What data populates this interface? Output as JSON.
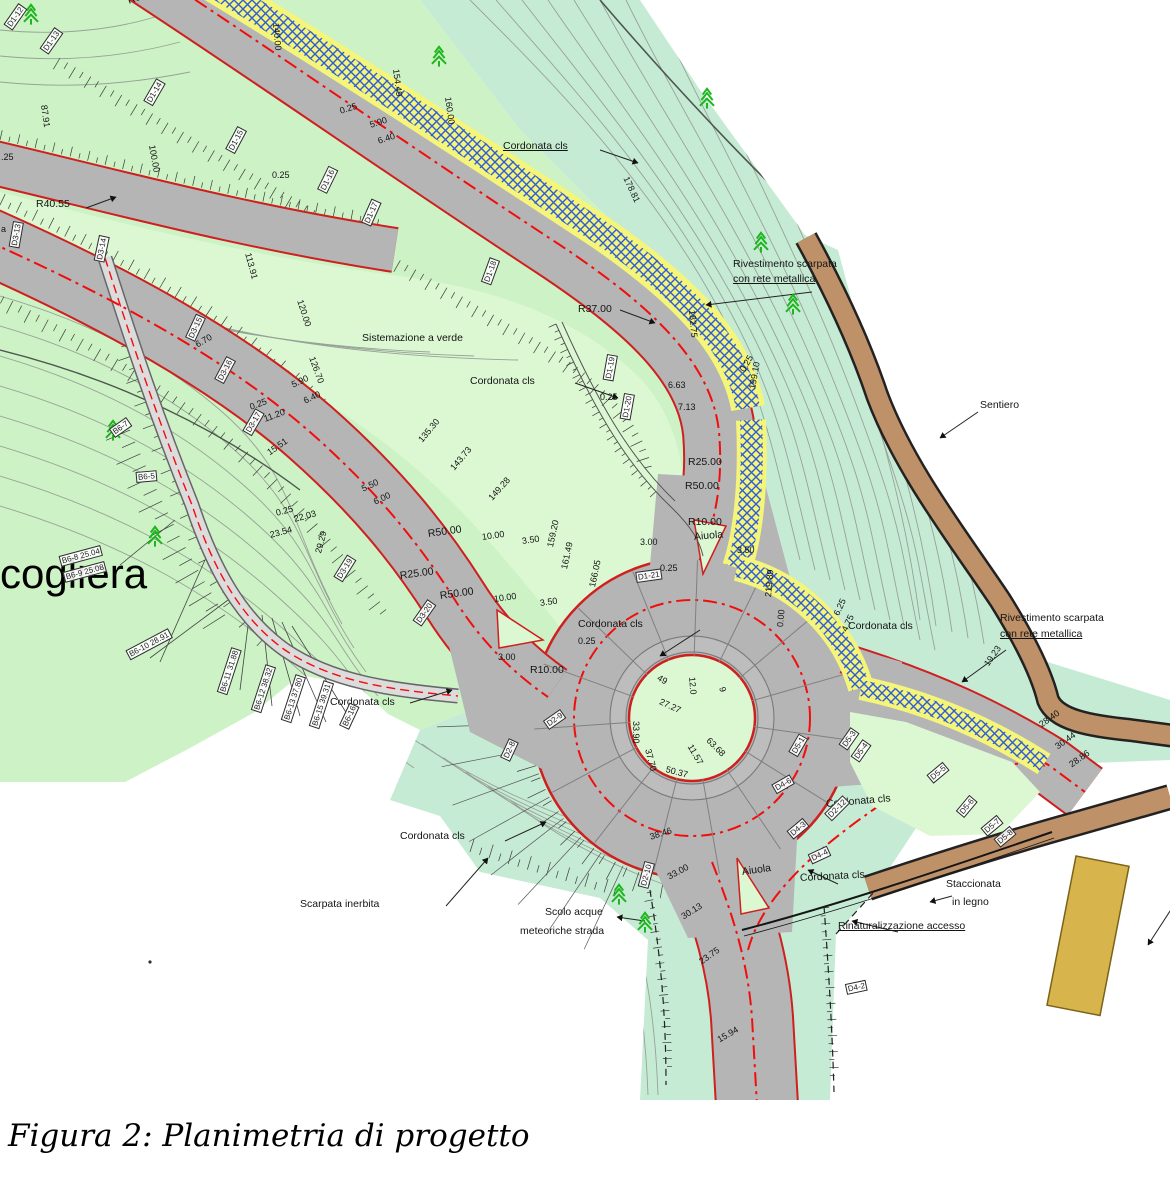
{
  "figure": {
    "caption": "Figura 2: Planimetria di progetto"
  },
  "map": {
    "colors": {
      "green": "#cdf2c5",
      "seafoam": "#c6ebd4",
      "mint": "#dcf8d2",
      "road": "#b5b5b5",
      "track": "#dcdcdc",
      "red_edge": "#cf1f1f",
      "red_dash": "#f20d0d",
      "hatch_yellow": "#f5f57a",
      "hatch_blue": "#2e5bd8",
      "brown": "#bf9169",
      "tan": "#d8b44c",
      "contour": "#97a297",
      "contour_bold": "#4e564e",
      "hatch_tick": "#3c3c3c",
      "tree": "#1db51d",
      "ink": "#111111"
    },
    "trees": [
      [
        22,
        2
      ],
      [
        430,
        44
      ],
      [
        698,
        86
      ],
      [
        752,
        230
      ],
      [
        784,
        292
      ],
      [
        104,
        418
      ],
      [
        146,
        524
      ],
      [
        610,
        882
      ],
      [
        636,
        910
      ]
    ],
    "point_marker": [
      150,
      962
    ],
    "labels": [
      {
        "t": "Cordonata cls",
        "x": 503,
        "y": 140,
        "r": 0,
        "c": "u"
      },
      {
        "t": "Rivestimento scarpata",
        "x": 733,
        "y": 258,
        "r": 0
      },
      {
        "t": "con rete metallica",
        "x": 733,
        "y": 273,
        "r": 0,
        "c": "u"
      },
      {
        "t": "Sentiero",
        "x": 980,
        "y": 399,
        "r": 0
      },
      {
        "t": "Sistemazione a verde",
        "x": 362,
        "y": 332,
        "r": 0
      },
      {
        "t": "Cordonata cls",
        "x": 470,
        "y": 375,
        "r": 0
      },
      {
        "t": "R37.00",
        "x": 578,
        "y": 303,
        "r": 0
      },
      {
        "t": "0.25",
        "x": 600,
        "y": 392,
        "r": 0,
        "c": "s"
      },
      {
        "t": "6.63",
        "x": 668,
        "y": 380,
        "r": 0,
        "c": "s"
      },
      {
        "t": "7.13",
        "x": 678,
        "y": 402,
        "r": 0,
        "c": "s"
      },
      {
        "t": "0.25",
        "x": 742,
        "y": 366,
        "r": -60,
        "c": "s"
      },
      {
        "t": "199.10",
        "x": 752,
        "y": 384,
        "r": -80,
        "c": "s"
      },
      {
        "t": "R25.00",
        "x": 688,
        "y": 456,
        "r": 0
      },
      {
        "t": "R50.00",
        "x": 685,
        "y": 480,
        "r": 0
      },
      {
        "t": "R10.00",
        "x": 688,
        "y": 516,
        "r": 0
      },
      {
        "t": "Aiuola",
        "x": 694,
        "y": 531,
        "r": -5
      },
      {
        "t": "3.50",
        "x": 737,
        "y": 545,
        "r": 0,
        "c": "s"
      },
      {
        "t": "0.25",
        "x": 660,
        "y": 563,
        "r": 0,
        "c": "s"
      },
      {
        "t": "3.00",
        "x": 640,
        "y": 537,
        "r": 0,
        "c": "s"
      },
      {
        "t": "R85.00",
        "x": 128,
        "y": -5,
        "r": -20
      },
      {
        "t": "0.25",
        "x": 340,
        "y": 106,
        "r": -18,
        "c": "s"
      },
      {
        "t": "5.90",
        "x": 370,
        "y": 120,
        "r": -18,
        "c": "s"
      },
      {
        "t": "6.40",
        "x": 378,
        "y": 136,
        "r": -18,
        "c": "s"
      },
      {
        "t": "0.25",
        "x": 272,
        "y": 170,
        "r": 0,
        "c": "s"
      },
      {
        "t": ".25",
        "x": 1,
        "y": 152,
        "r": 0,
        "c": "s"
      },
      {
        "t": "R40.55",
        "x": 36,
        "y": 198,
        "r": 0
      },
      {
        "t": "a",
        "x": 1,
        "y": 224,
        "r": 0,
        "c": "s"
      },
      {
        "t": "cogliera",
        "x": 0,
        "y": 552,
        "r": 0,
        "c": "big"
      },
      {
        "t": "Cordonata cls",
        "x": 330,
        "y": 696,
        "r": 0
      },
      {
        "t": "R25.00",
        "x": 400,
        "y": 570,
        "r": -8
      },
      {
        "t": "R50.00",
        "x": 428,
        "y": 528,
        "r": -8
      },
      {
        "t": "10.00",
        "x": 482,
        "y": 532,
        "r": -8,
        "c": "s"
      },
      {
        "t": "3.50",
        "x": 522,
        "y": 536,
        "r": -8,
        "c": "s"
      },
      {
        "t": "R50.00",
        "x": 440,
        "y": 590,
        "r": -8
      },
      {
        "t": "10.00",
        "x": 494,
        "y": 594,
        "r": -8,
        "c": "s"
      },
      {
        "t": "3.50",
        "x": 540,
        "y": 598,
        "r": -8,
        "c": "s"
      },
      {
        "t": "0.25",
        "x": 578,
        "y": 636,
        "r": 0,
        "c": "s"
      },
      {
        "t": "3.00",
        "x": 498,
        "y": 652,
        "r": 0,
        "c": "s"
      },
      {
        "t": "R10.00",
        "x": 530,
        "y": 664,
        "r": 0
      },
      {
        "t": "Cordonata cls",
        "x": 578,
        "y": 618,
        "r": 0
      },
      {
        "t": "5.50",
        "x": 362,
        "y": 484,
        "r": -25,
        "c": "s"
      },
      {
        "t": "6.00",
        "x": 374,
        "y": 497,
        "r": -25,
        "c": "s"
      },
      {
        "t": "5.90",
        "x": 292,
        "y": 380,
        "r": -25,
        "c": "s"
      },
      {
        "t": "6.40",
        "x": 304,
        "y": 396,
        "r": -25,
        "c": "s"
      },
      {
        "t": "6.70",
        "x": 196,
        "y": 340,
        "r": -30,
        "c": "s"
      },
      {
        "t": "0.25",
        "x": 250,
        "y": 402,
        "r": -20,
        "c": "s"
      },
      {
        "t": "11.20",
        "x": 264,
        "y": 414,
        "r": -20,
        "c": "s"
      },
      {
        "t": "15.51",
        "x": 268,
        "y": 448,
        "r": -35,
        "c": "s"
      },
      {
        "t": "0.25",
        "x": 276,
        "y": 508,
        "r": -15,
        "c": "s"
      },
      {
        "t": "22.03",
        "x": 294,
        "y": 514,
        "r": -15,
        "c": "s"
      },
      {
        "t": "23.54",
        "x": 270,
        "y": 530,
        "r": -15,
        "c": "s"
      },
      {
        "t": "29.29",
        "x": 318,
        "y": 548,
        "r": -75,
        "c": "s"
      },
      {
        "t": "Scarpata inerbita",
        "x": 300,
        "y": 898,
        "r": 0
      },
      {
        "t": "Scolo acque",
        "x": 545,
        "y": 906,
        "r": 0
      },
      {
        "t": "meteoriche strada",
        "x": 520,
        "y": 925,
        "r": 0
      },
      {
        "t": "Cordonata cls",
        "x": 400,
        "y": 830,
        "r": 0
      },
      {
        "t": "38.46",
        "x": 650,
        "y": 832,
        "r": -18,
        "c": "s"
      },
      {
        "t": "33.00",
        "x": 668,
        "y": 872,
        "r": -28,
        "c": "s"
      },
      {
        "t": "30.13",
        "x": 682,
        "y": 912,
        "r": -32,
        "c": "s"
      },
      {
        "t": "23.75",
        "x": 700,
        "y": 957,
        "r": -35,
        "c": "s"
      },
      {
        "t": "15.94",
        "x": 718,
        "y": 1035,
        "r": -30,
        "c": "s"
      },
      {
        "t": "Aiuola",
        "x": 742,
        "y": 866,
        "r": -8
      },
      {
        "t": "Cordonata cls",
        "x": 800,
        "y": 872,
        "r": -3
      },
      {
        "t": "Staccionata",
        "x": 946,
        "y": 878,
        "r": 0
      },
      {
        "t": "in legno",
        "x": 952,
        "y": 896,
        "r": 0
      },
      {
        "t": "Rinaturalizzazione accesso",
        "x": 838,
        "y": 920,
        "r": 0,
        "c": "u"
      },
      {
        "t": "Cordonata cls",
        "x": 848,
        "y": 620,
        "r": 0
      },
      {
        "t": "Cordonata cls",
        "x": 826,
        "y": 798,
        "r": -5
      },
      {
        "t": "Rivestimento scarpata",
        "x": 1000,
        "y": 612,
        "r": 0
      },
      {
        "t": "con rete metallica",
        "x": 1000,
        "y": 628,
        "r": 0,
        "c": "u"
      },
      {
        "t": "6.25",
        "x": 836,
        "y": 610,
        "r": -65,
        "c": "s"
      },
      {
        "t": "4.75",
        "x": 844,
        "y": 626,
        "r": -65,
        "c": "s"
      },
      {
        "t": "19.23",
        "x": 986,
        "y": 660,
        "r": -55,
        "c": "s"
      },
      {
        "t": "28.40",
        "x": 1040,
        "y": 720,
        "r": -35,
        "c": "s"
      },
      {
        "t": "30.44",
        "x": 1056,
        "y": 742,
        "r": -35,
        "c": "s"
      },
      {
        "t": "28.86",
        "x": 1070,
        "y": 760,
        "r": -35,
        "c": "s"
      },
      {
        "t": "87.91",
        "x": 44,
        "y": 100,
        "r": 82,
        "c": "s"
      },
      {
        "t": "100.00",
        "x": 152,
        "y": 140,
        "r": 80,
        "c": "s"
      },
      {
        "t": "113.91",
        "x": 248,
        "y": 248,
        "r": 75,
        "c": "s"
      },
      {
        "t": "120.00",
        "x": 300,
        "y": 295,
        "r": 72,
        "c": "s"
      },
      {
        "t": "126.70",
        "x": 312,
        "y": 352,
        "r": 70,
        "c": "s"
      },
      {
        "t": "140.00",
        "x": 276,
        "y": 18,
        "r": 85,
        "c": "s"
      },
      {
        "t": "154.49",
        "x": 396,
        "y": 64,
        "r": 83,
        "c": "s"
      },
      {
        "t": "160.00",
        "x": 448,
        "y": 92,
        "r": 82,
        "c": "s"
      },
      {
        "t": "178.81",
        "x": 626,
        "y": 172,
        "r": 65,
        "c": "s"
      },
      {
        "t": "182.75",
        "x": 692,
        "y": 305,
        "r": 85,
        "c": "s"
      },
      {
        "t": "135.30",
        "x": 420,
        "y": 436,
        "r": -50,
        "c": "s"
      },
      {
        "t": "143.73",
        "x": 452,
        "y": 464,
        "r": -50,
        "c": "s"
      },
      {
        "t": "149.28",
        "x": 490,
        "y": 494,
        "r": -48,
        "c": "s"
      },
      {
        "t": "159.20",
        "x": 550,
        "y": 542,
        "r": -78,
        "c": "s"
      },
      {
        "t": "161.49",
        "x": 564,
        "y": 564,
        "r": -78,
        "c": "s"
      },
      {
        "t": "166.05",
        "x": 592,
        "y": 582,
        "r": -78,
        "c": "s"
      },
      {
        "t": "219.89",
        "x": 768,
        "y": 592,
        "r": -85,
        "c": "s"
      },
      {
        "t": "0.00",
        "x": 780,
        "y": 622,
        "r": -85,
        "c": "s"
      },
      {
        "t": "33.90",
        "x": 636,
        "y": 716,
        "r": 90,
        "c": "s"
      },
      {
        "t": "37.70",
        "x": 648,
        "y": 744,
        "r": 75,
        "c": "s"
      },
      {
        "t": "27.27",
        "x": 660,
        "y": 696,
        "r": 25,
        "c": "s"
      },
      {
        "t": "11.57",
        "x": 690,
        "y": 740,
        "r": 60,
        "c": "s"
      },
      {
        "t": "50.37",
        "x": 666,
        "y": 764,
        "r": 15,
        "c": "s"
      },
      {
        "t": "63.68",
        "x": 708,
        "y": 734,
        "r": 45,
        "c": "s"
      },
      {
        "t": "12.0",
        "x": 692,
        "y": 672,
        "r": 85,
        "c": "s"
      },
      {
        "t": "49",
        "x": 658,
        "y": 672,
        "r": 30,
        "c": "s"
      },
      {
        "t": "9",
        "x": 722,
        "y": 682,
        "r": 75,
        "c": "s"
      },
      {
        "t": "D1-12",
        "x": 8,
        "y": 22,
        "r": -55,
        "c": "b"
      },
      {
        "t": "D1-13",
        "x": 44,
        "y": 46,
        "r": -55,
        "c": "b"
      },
      {
        "t": "D1-14",
        "x": 148,
        "y": 98,
        "r": -60,
        "c": "b"
      },
      {
        "t": "D1-15",
        "x": 230,
        "y": 146,
        "r": -62,
        "c": "b"
      },
      {
        "t": "D1-16",
        "x": 322,
        "y": 186,
        "r": -64,
        "c": "b"
      },
      {
        "t": "D1-17",
        "x": 366,
        "y": 219,
        "r": -66,
        "c": "b"
      },
      {
        "t": "D1-18",
        "x": 486,
        "y": 278,
        "r": -70,
        "c": "b"
      },
      {
        "t": "D1-19",
        "x": 608,
        "y": 375,
        "r": -80,
        "c": "b"
      },
      {
        "t": "D1-20",
        "x": 625,
        "y": 414,
        "r": -80,
        "c": "b"
      },
      {
        "t": "D1-21",
        "x": 636,
        "y": 572,
        "r": -8,
        "c": "b"
      },
      {
        "t": "D3-13",
        "x": 14,
        "y": 242,
        "r": -80,
        "c": "b"
      },
      {
        "t": "D3-14",
        "x": 99,
        "y": 256,
        "r": -78,
        "c": "b"
      },
      {
        "t": "D3-15",
        "x": 190,
        "y": 334,
        "r": -65,
        "c": "b"
      },
      {
        "t": "D3-16",
        "x": 219,
        "y": 376,
        "r": -62,
        "c": "b"
      },
      {
        "t": "D3-17",
        "x": 247,
        "y": 428,
        "r": -60,
        "c": "b"
      },
      {
        "t": "D3-19",
        "x": 338,
        "y": 574,
        "r": -58,
        "c": "b"
      },
      {
        "t": "D3-20",
        "x": 417,
        "y": 618,
        "r": -55,
        "c": "b"
      },
      {
        "t": "D2-8",
        "x": 505,
        "y": 754,
        "r": -65,
        "c": "b"
      },
      {
        "t": "D2-9",
        "x": 546,
        "y": 720,
        "r": -35,
        "c": "b"
      },
      {
        "t": "D2-10",
        "x": 643,
        "y": 882,
        "r": -75,
        "c": "b"
      },
      {
        "t": "D2-12",
        "x": 828,
        "y": 812,
        "r": -45,
        "c": "b"
      },
      {
        "t": "D5-1",
        "x": 793,
        "y": 749,
        "r": -60,
        "c": "b"
      },
      {
        "t": "D5-3",
        "x": 843,
        "y": 742,
        "r": -55,
        "c": "b"
      },
      {
        "t": "D5-4",
        "x": 855,
        "y": 754,
        "r": -55,
        "c": "b"
      },
      {
        "t": "D5-5",
        "x": 930,
        "y": 774,
        "r": -40,
        "c": "b"
      },
      {
        "t": "D5-6",
        "x": 960,
        "y": 809,
        "r": -50,
        "c": "b"
      },
      {
        "t": "D5-7",
        "x": 984,
        "y": 827,
        "r": -40,
        "c": "b"
      },
      {
        "t": "D5-8",
        "x": 997,
        "y": 838,
        "r": -40,
        "c": "b"
      },
      {
        "t": "D4-2",
        "x": 846,
        "y": 984,
        "r": -12,
        "c": "b"
      },
      {
        "t": "D4-3",
        "x": 790,
        "y": 830,
        "r": -40,
        "c": "b"
      },
      {
        "t": "D4-4",
        "x": 810,
        "y": 854,
        "r": -25,
        "c": "b"
      },
      {
        "t": "D4-6",
        "x": 774,
        "y": 784,
        "r": -30,
        "c": "b"
      },
      {
        "t": "B6-7",
        "x": 112,
        "y": 428,
        "r": -35,
        "c": "b"
      },
      {
        "t": "B6-5",
        "x": 136,
        "y": 472,
        "r": -5,
        "c": "b"
      },
      {
        "t": "B6-8 25.04",
        "x": 60,
        "y": 556,
        "r": -15,
        "c": "b"
      },
      {
        "t": "B6-9 25.08",
        "x": 64,
        "y": 572,
        "r": -15,
        "c": "b"
      },
      {
        "t": "B6-10 28.91",
        "x": 128,
        "y": 650,
        "r": -28,
        "c": "b"
      },
      {
        "t": "B6-11 31.88",
        "x": 222,
        "y": 688,
        "r": -72,
        "c": "b"
      },
      {
        "t": "B6-12 38.32",
        "x": 256,
        "y": 706,
        "r": -72,
        "c": "b"
      },
      {
        "t": "B6-13 37.80",
        "x": 286,
        "y": 716,
        "r": -72,
        "c": "b"
      },
      {
        "t": "B6-15 39.31",
        "x": 314,
        "y": 722,
        "r": -72,
        "c": "b"
      },
      {
        "t": "B6-16",
        "x": 344,
        "y": 722,
        "r": -65,
        "c": "b"
      }
    ]
  }
}
